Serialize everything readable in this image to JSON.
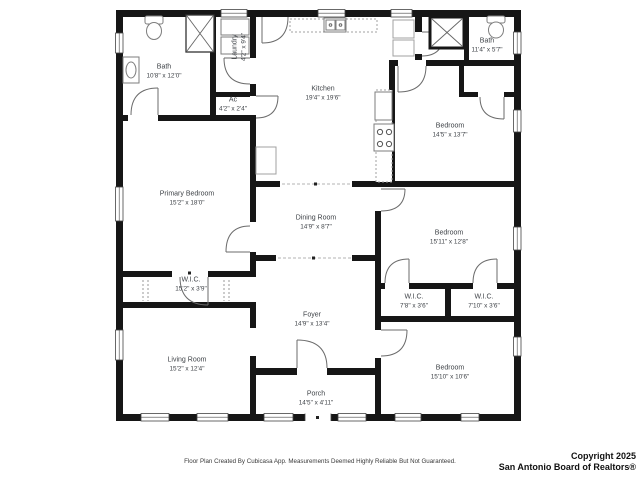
{
  "colors": {
    "wall": "#161616",
    "fixture": "#7e7e7e",
    "text": "#3f4348"
  },
  "rooms": [
    {
      "name": "Bath",
      "dims": "10'8\" x 12'0\""
    },
    {
      "name": "Laundry",
      "dims": "4'2\" x 9'4\""
    },
    {
      "name": "Ac",
      "dims": "4'2\" x 2'4\""
    },
    {
      "name": "Kitchen",
      "dims": "19'4\" x 19'6\""
    },
    {
      "name": "Bath",
      "dims": "11'4\" x 5'7\""
    },
    {
      "name": "Bedroom",
      "dims": "14'5\" x 13'7\""
    },
    {
      "name": "Primary Bedroom",
      "dims": "15'2\" x 18'0\""
    },
    {
      "name": "Dining Room",
      "dims": "14'9\" x 8'7\""
    },
    {
      "name": "Bedroom",
      "dims": "15'11\" x 12'8\""
    },
    {
      "name": "W.I.C.",
      "dims": "15'2\" x 3'9\""
    },
    {
      "name": "Living Room",
      "dims": "15'2\" x 12'4\""
    },
    {
      "name": "Foyer",
      "dims": "14'9\" x 13'4\""
    },
    {
      "name": "W.I.C.",
      "dims": "7'8\" x 3'6\""
    },
    {
      "name": "W.I.C.",
      "dims": "7'10\" x 3'6\""
    },
    {
      "name": "Bedroom",
      "dims": "15'10\" x 10'6\""
    },
    {
      "name": "Porch",
      "dims": "14'5\" x 4'11\""
    }
  ],
  "footer": {
    "disclaimer": "Floor Plan Created By Cubicasa App. Measurements Deemed Highly Reliable But Not Guaranteed.",
    "copyright_line1": "Copyright 2025",
    "copyright_line2": "San Antonio Board of Realtors®"
  }
}
